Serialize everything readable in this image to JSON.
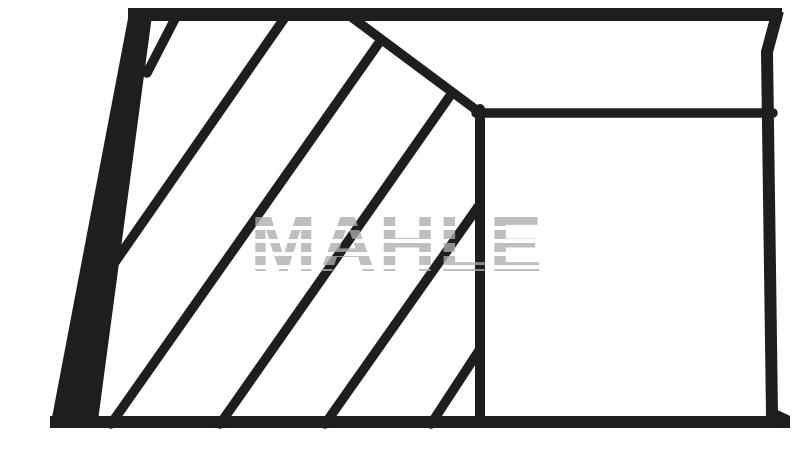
{
  "canvas": {
    "width": 798,
    "height": 473,
    "background_color": "#ffffff"
  },
  "watermark": {
    "text": "MAHLE",
    "color": "#c3c3c3",
    "style": "horizontal-striped, semi-transparent, overlays drawing"
  },
  "drawing": {
    "description": "Piston ring cross-section technical line drawing (trapezoidal outline with diagonal section hatching on the left, plain rectangular land on the right, chamfer from top edge down to inner corner)",
    "line_color": "#1e1e1e",
    "shapes": [
      {
        "name": "top-edge",
        "type": "rect",
        "x": 128,
        "y": 8,
        "w": 654,
        "h": 13
      },
      {
        "name": "left-edge-wedge",
        "type": "polygon",
        "points": "130,8 153,8 97,428 50,428"
      },
      {
        "name": "bottom-edge",
        "type": "rect",
        "x": 50,
        "y": 416,
        "w": 740,
        "h": 12
      },
      {
        "name": "right-edge",
        "type": "polyline",
        "points": "778,11 767,52 772,414 787,421",
        "stroke_width": 12
      },
      {
        "name": "chamfer-line",
        "type": "line",
        "x1": 350,
        "y1": 16,
        "x2": 479,
        "y2": 112,
        "stroke_width": 9.5
      },
      {
        "name": "inner-horizontal-line",
        "type": "line",
        "x1": 476,
        "y1": 113,
        "x2": 773,
        "y2": 113,
        "stroke_width": 9.5
      },
      {
        "name": "inner-vertical-line",
        "type": "line",
        "x1": 480,
        "y1": 109,
        "x2": 480,
        "y2": 422,
        "stroke_width": 10
      },
      {
        "name": "hatch-line-1",
        "type": "line",
        "x1": 178,
        "y1": 13,
        "x2": 147,
        "y2": 73,
        "stroke_width": 9.5
      },
      {
        "name": "hatch-line-2",
        "type": "line",
        "x1": 288,
        "y1": 13,
        "x2": 104,
        "y2": 278,
        "stroke_width": 9.5
      },
      {
        "name": "hatch-line-3",
        "type": "line",
        "x1": 381,
        "y1": 40,
        "x2": 111,
        "y2": 424,
        "stroke_width": 9.5
      },
      {
        "name": "hatch-line-4",
        "type": "line",
        "x1": 452,
        "y1": 93,
        "x2": 220,
        "y2": 424,
        "stroke_width": 9.5
      },
      {
        "name": "hatch-line-5",
        "type": "line",
        "x1": 480,
        "y1": 204,
        "x2": 325,
        "y2": 424,
        "stroke_width": 9.5
      },
      {
        "name": "hatch-line-6",
        "type": "line",
        "x1": 480,
        "y1": 349,
        "x2": 431,
        "y2": 424,
        "stroke_width": 9.5
      }
    ]
  }
}
